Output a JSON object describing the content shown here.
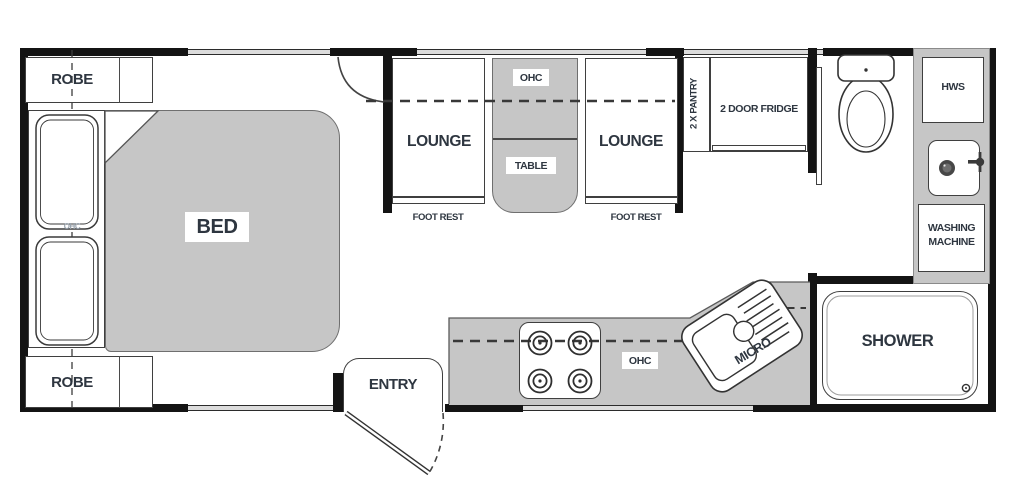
{
  "colors": {
    "wall": "#141414",
    "furniture": "#c6c6c6",
    "outline": "#3f3f3f",
    "window": "#dcdcdc",
    "label_text": "#2e3640"
  },
  "bedroom": {
    "robe_top": "ROBE",
    "robe_bottom": "ROBE",
    "bed": "BED",
    "pillow_ohc": "OHC"
  },
  "lounge": {
    "left": "LOUNGE",
    "right": "LOUNGE",
    "foot_rest_left": "FOOT REST",
    "foot_rest_right": "FOOT REST",
    "ohc": "OHC",
    "table": "TABLE"
  },
  "kitchen": {
    "pantry": "2 X PANTRY",
    "fridge": "2 DOOR FRIDGE",
    "ohc": "OHC",
    "micro": "MICRO",
    "entry": "ENTRY"
  },
  "utility": {
    "hws": "HWS",
    "washing_machine": "WASHING MACHINE",
    "shower": "SHOWER"
  }
}
